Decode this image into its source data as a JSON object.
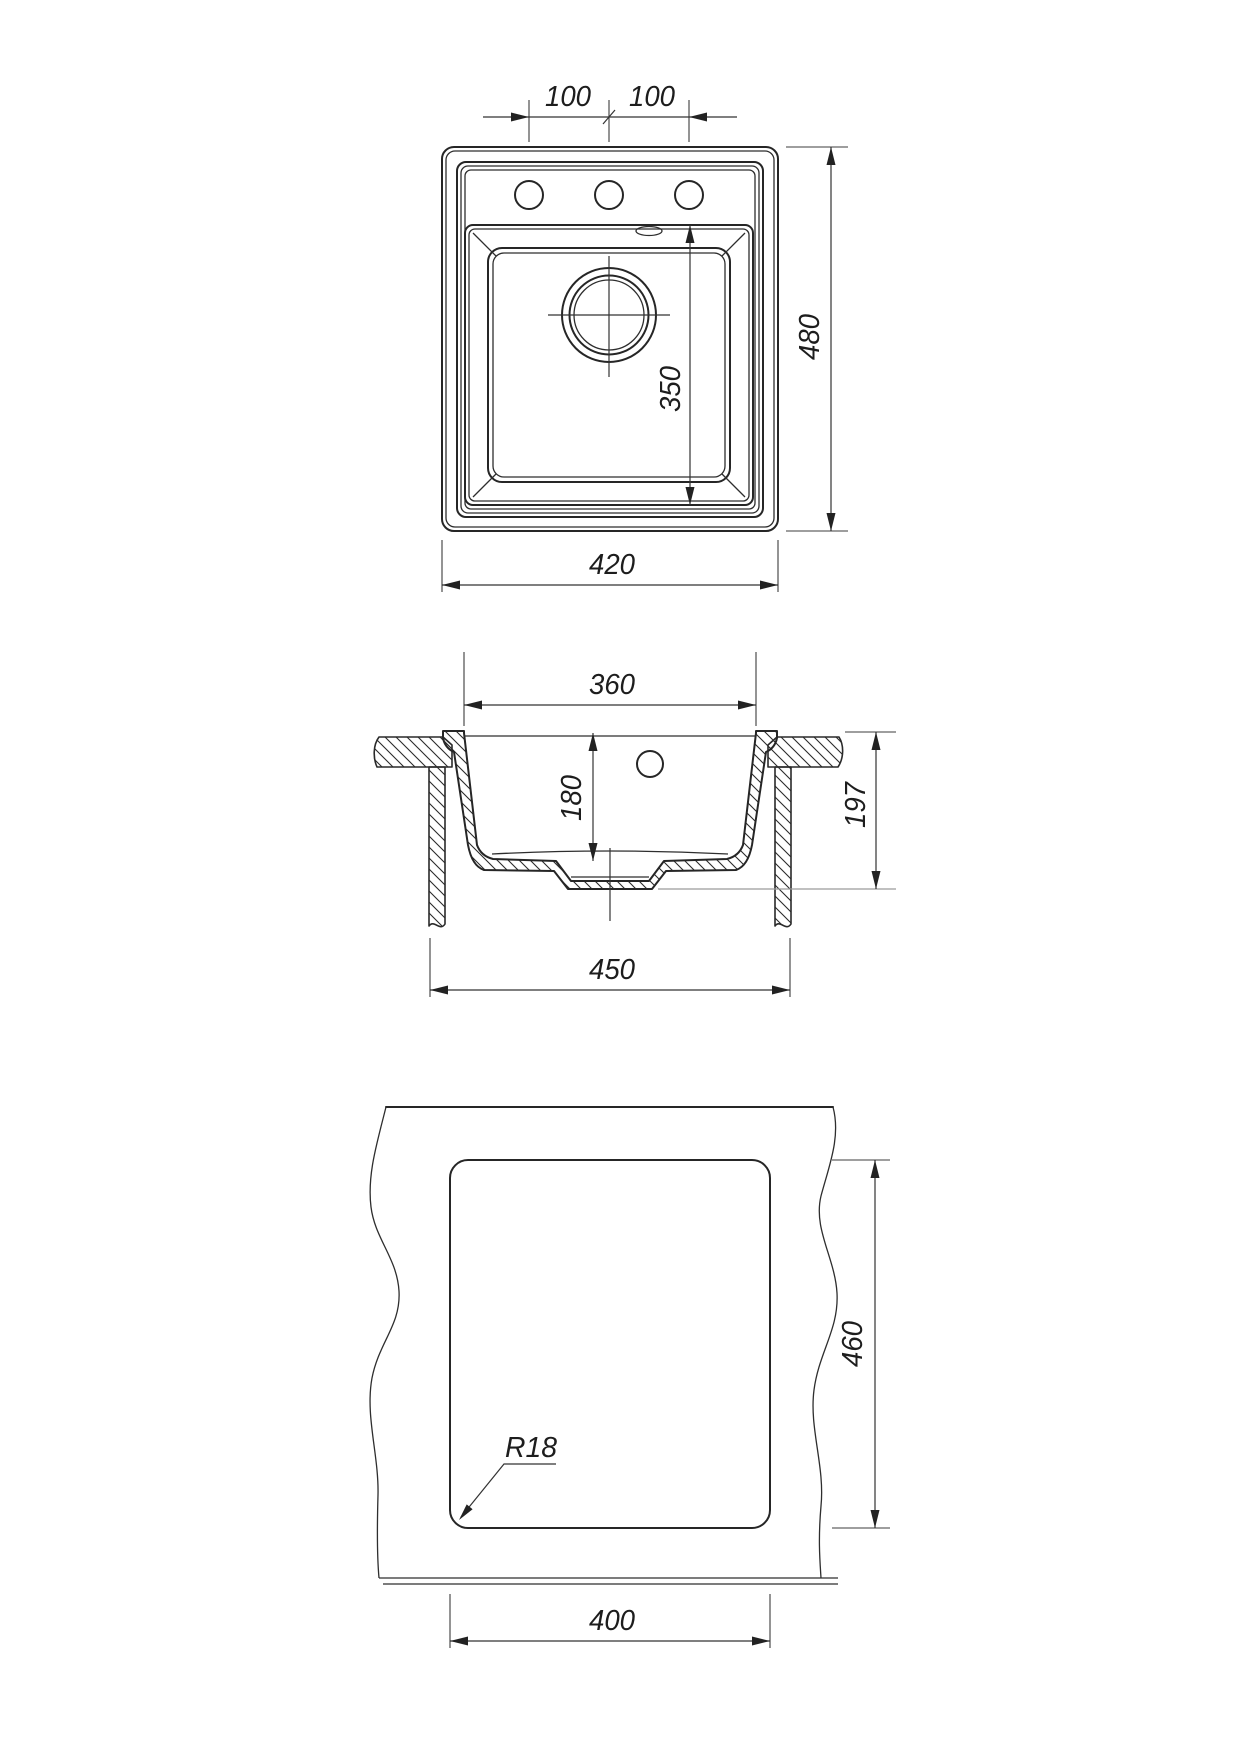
{
  "drawing": {
    "type": "kitchen sink installation drawing, three orthographic views",
    "colors": {
      "line": "#262626",
      "background": "#ffffff"
    },
    "labels": {
      "top_view": {
        "hole_spacing_left": "100",
        "hole_spacing_right": "100",
        "overall_depth": "480",
        "bowl_length": "350",
        "overall_width": "420"
      },
      "section_view": {
        "bowl_width": "360",
        "bowl_depth": "180",
        "overall_height": "197",
        "cabinet_width": "450"
      },
      "cutout_view": {
        "cutout_height": "460",
        "corner_radius": "R18",
        "cutout_width": "400"
      }
    }
  }
}
